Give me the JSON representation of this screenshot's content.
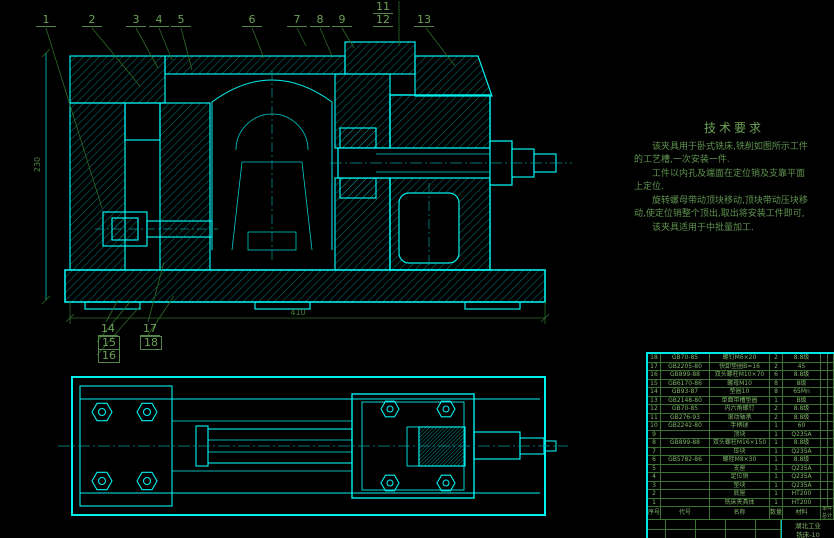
{
  "colors": {
    "line": "#00ffff",
    "hatch": "#00b0b0",
    "text_green": "#6da257",
    "dim_green": "#49803a"
  },
  "callouts": {
    "top": [
      "1",
      "2",
      "3",
      "4",
      "5",
      "6",
      "7",
      "8",
      "9",
      "11",
      "12",
      "13"
    ],
    "left": [
      "14",
      "15",
      "16",
      "17",
      "18"
    ]
  },
  "dims": {
    "h": "410",
    "v": "230"
  },
  "tech": {
    "title": "技术要求",
    "lines": [
      "该夹具用于卧式铣床,铣削如图所示工件",
      "的工艺槽,一次安装一件.",
      "工件以内孔及端面在定位销及支靠平面",
      "上定位.",
      "旋转螺母带动顶块移动,顶块带动压块移",
      "动,使定位销整个顶出,取出将安装工件即可,",
      "该夹具适用于中批量加工."
    ]
  },
  "bom": {
    "header": {
      "no": "序号",
      "code": "代号",
      "name": "名称",
      "qty": "数量",
      "material": "材料",
      "weight": "单件 总计 重量"
    },
    "rows": [
      [
        "18",
        "GB70-85",
        "螺钉M6×20",
        "2",
        "8.8级",
        "",
        ""
      ],
      [
        "17",
        "GB2205-80",
        "快卸垫圈B=16",
        "2",
        "45",
        "",
        ""
      ],
      [
        "16",
        "GB899-88",
        "双头螺柱M10×70",
        "6",
        "8.8级",
        "",
        ""
      ],
      [
        "15",
        "GB6170-86",
        "螺母M10",
        "8",
        "8级",
        "",
        ""
      ],
      [
        "14",
        "GB93-87",
        "垫圈10",
        "8",
        "65Mn",
        "",
        ""
      ],
      [
        "13",
        "GB2148-80",
        "单面带槽垫圈",
        "1",
        "B级",
        "",
        ""
      ],
      [
        "12",
        "GB70-85",
        "内六角螺钉",
        "2",
        "8.8级",
        "",
        ""
      ],
      [
        "11",
        "GB276-93",
        "滚动轴承",
        "2",
        "8.8级",
        "",
        ""
      ],
      [
        "10",
        "GB2242-80",
        "手柄球",
        "1",
        "60",
        "",
        ""
      ],
      [
        "9",
        "",
        "顶块",
        "1",
        "Q235A",
        "",
        ""
      ],
      [
        "8",
        "GB899-88",
        "双头螺柱M16×150",
        "1",
        "8.8级",
        "",
        ""
      ],
      [
        "7",
        "",
        "压块",
        "1",
        "Q235A",
        "",
        ""
      ],
      [
        "6",
        "GB5782-86",
        "螺栓M8×30",
        "1",
        "8.8级",
        "",
        ""
      ],
      [
        "5",
        "",
        "支座",
        "1",
        "Q235A",
        "",
        ""
      ],
      [
        "4",
        "",
        "定位销",
        "1",
        "Q235A",
        "",
        ""
      ],
      [
        "3",
        "",
        "垫块",
        "1",
        "Q235A",
        "",
        ""
      ],
      [
        "2",
        "",
        "底座",
        "1",
        "HT200",
        "",
        ""
      ],
      [
        "1",
        "",
        "铣床夹具体",
        "1",
        "HT200",
        "",
        ""
      ]
    ]
  },
  "title_block": {
    "org": "湖北工业",
    "drawing_no": "铣床-10"
  }
}
